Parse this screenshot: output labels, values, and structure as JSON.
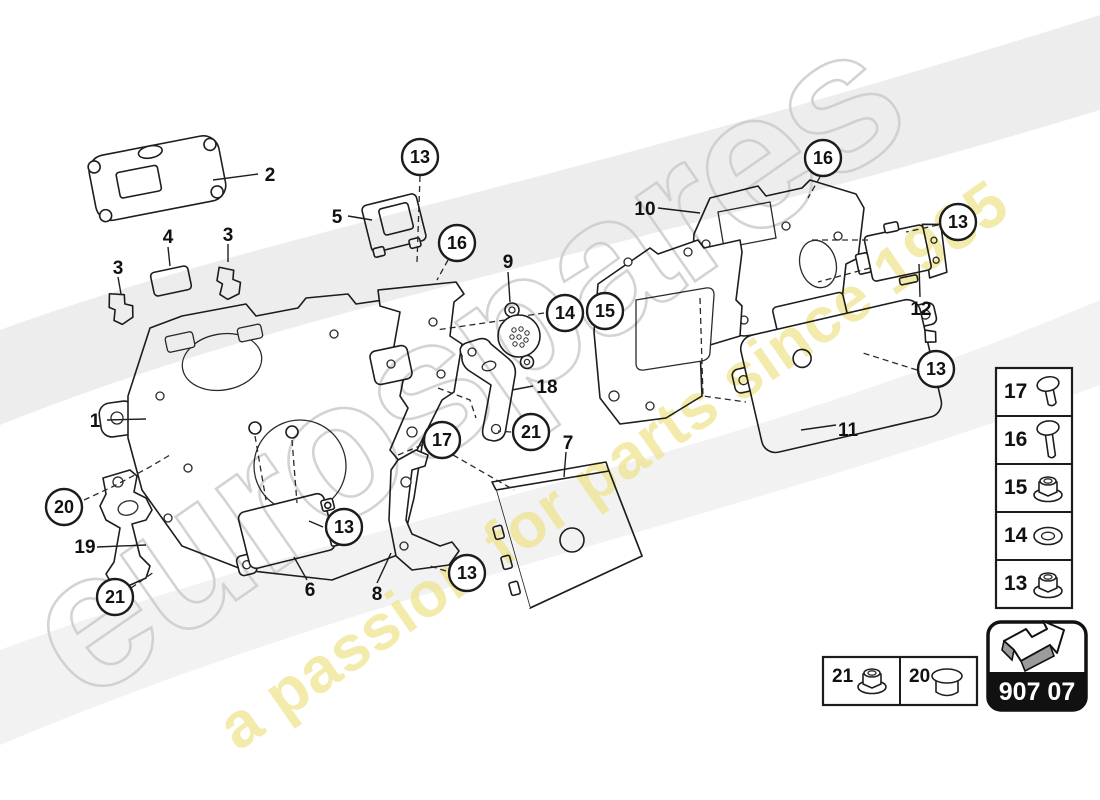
{
  "watermark": {
    "brand": "eurospares",
    "tagline": "a passion for parts since 1985"
  },
  "diagram_code": {
    "label": "907 07"
  },
  "callouts": [
    {
      "label": "13"
    },
    {
      "label": "16"
    },
    {
      "label": "14"
    },
    {
      "label": "15"
    },
    {
      "label": "16"
    },
    {
      "label": "13"
    },
    {
      "label": "13"
    },
    {
      "label": "17"
    },
    {
      "label": "21"
    },
    {
      "label": "13"
    },
    {
      "label": "13"
    },
    {
      "label": "20"
    },
    {
      "label": "21"
    }
  ],
  "part_labels": [
    {
      "label": "2"
    },
    {
      "label": "5"
    },
    {
      "label": "4"
    },
    {
      "label": "3"
    },
    {
      "label": "3"
    },
    {
      "label": "1"
    },
    {
      "label": "9"
    },
    {
      "label": "10"
    },
    {
      "label": "12"
    },
    {
      "label": "11"
    },
    {
      "label": "18"
    },
    {
      "label": "7"
    },
    {
      "label": "6"
    },
    {
      "label": "8"
    },
    {
      "label": "19"
    }
  ],
  "legend": {
    "rows": [
      {
        "num": "17",
        "icon": "screw-short"
      },
      {
        "num": "16",
        "icon": "screw-long"
      },
      {
        "num": "15",
        "icon": "flange-nut"
      },
      {
        "num": "14",
        "icon": "washer"
      },
      {
        "num": "13",
        "icon": "flange-nut"
      }
    ]
  },
  "hardware_strip": {
    "cells": [
      {
        "num": "21",
        "icon": "flange-nut"
      },
      {
        "num": "20",
        "icon": "bushing"
      }
    ]
  }
}
